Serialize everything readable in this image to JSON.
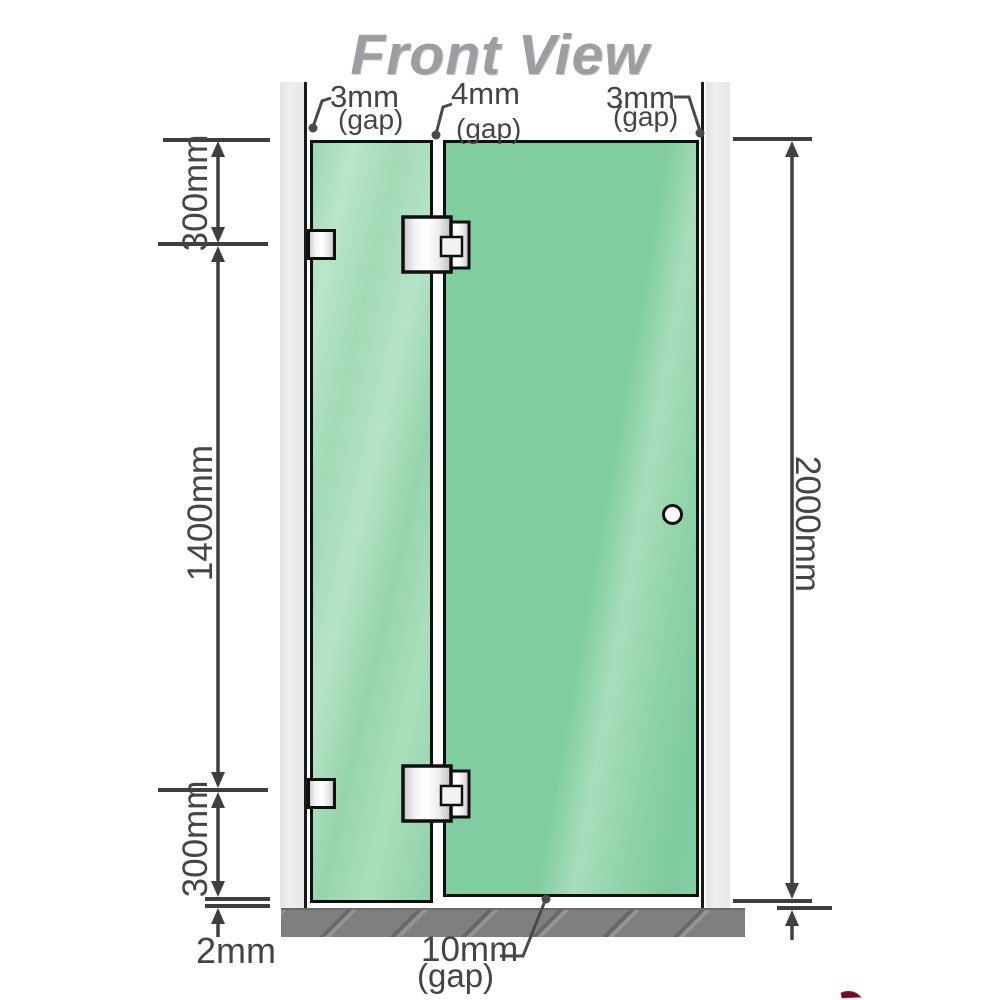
{
  "title": "Front View",
  "labels": {
    "gap_top_left": {
      "value": "3mm",
      "suffix": "(gap)"
    },
    "gap_top_middle": {
      "value": "4mm",
      "suffix": "(gap)"
    },
    "gap_top_right": {
      "value": "3mm",
      "suffix": "(gap)"
    },
    "dim_left_top": "300mm",
    "dim_left_middle": "1400mm",
    "dim_left_bottom": "300mm",
    "dim_floor_gap": "2mm",
    "dim_right_height": "2000mm",
    "gap_bottom": {
      "value": "10mm",
      "suffix": "(gap)"
    }
  },
  "colors": {
    "glass_green": "#7fcc9f",
    "glass_green_light": "#a8ddbb",
    "fixed_panel_green": "#a2dab6",
    "wall_gray": "#e9e9e9",
    "floor_gray": "#7f7f7f",
    "dimension_line": "#3f3f3f",
    "label_text": "#454545",
    "title_gray": "#9c9ea2",
    "hinge_metal": "#e8e8e8",
    "outline_black": "#0f0f0f",
    "logo_red": "#6e0f1f"
  }
}
